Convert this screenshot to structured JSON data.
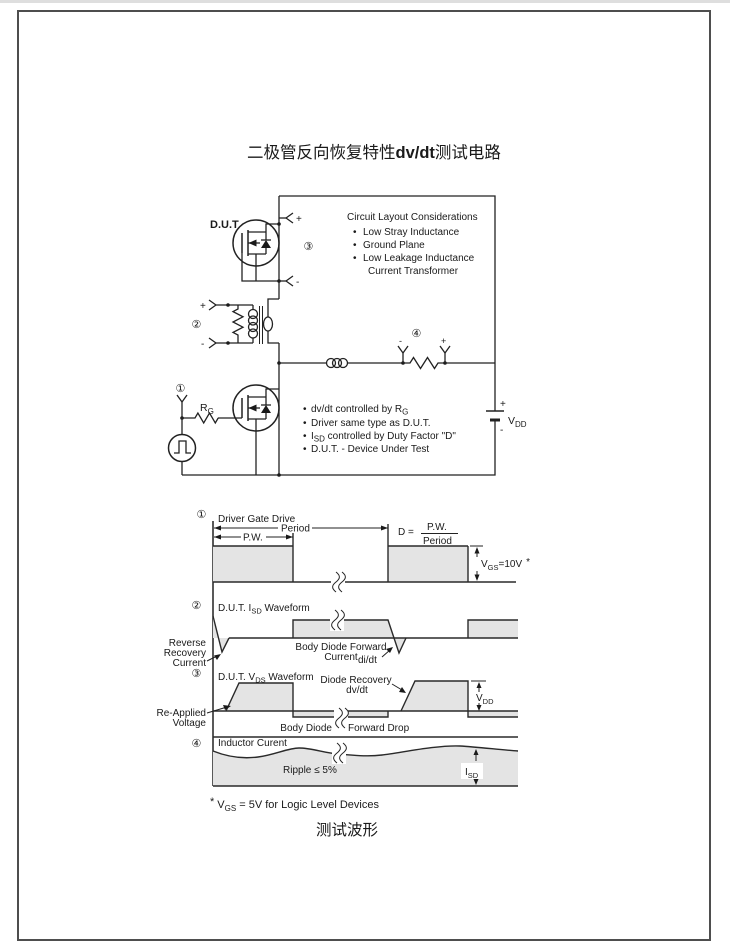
{
  "page": {
    "title": {
      "pre": "二极管反向恢复特性",
      "mid": "dv/dt",
      "post": "测试电路"
    },
    "bottom_title": "测试波形",
    "footnote": {
      "star": "*",
      "base": "V",
      "sub": "GS",
      "rest": " = 5V for Logic Level Devices"
    }
  },
  "symbols": {
    "plus": "+",
    "minus": "-",
    "bullet": "•"
  },
  "markers": {
    "m1": "①",
    "m2": "②",
    "m3": "③",
    "m4": "④"
  },
  "circuit": {
    "dut_label": "D.U.T",
    "rg": {
      "base": "R",
      "sub": "G"
    },
    "vdd": {
      "base": "V",
      "sub": "DD"
    },
    "layout_box": {
      "title": "Circuit Layout Considerations",
      "items": [
        "Low Stray Inductance",
        "Ground Plane",
        "Low Leakage Inductance"
      ],
      "continuation": "Current Transformer"
    },
    "notes": {
      "n1": {
        "pre": "dv/dt controlled by R",
        "sub": "G"
      },
      "n2": "Driver same type as D.U.T.",
      "n3": {
        "pre": "I",
        "sub": "SD",
        "post": " controlled by Duty Factor \"D\""
      },
      "n4": "D.U.T. - Device Under Test"
    }
  },
  "waveforms": {
    "w1": {
      "title": "Driver Gate Drive",
      "pw": "P.W.",
      "period": "Period",
      "duty_lhs": "D =",
      "duty_num": "P.W.",
      "duty_den": "Period",
      "vgs": {
        "base": "V",
        "sub": "GS",
        "value": "=10V",
        "star": "*"
      }
    },
    "w2": {
      "title_pre": "D.U.T. I",
      "title_sub": "SD",
      "title_post": " Waveform",
      "left1": "Reverse",
      "left2": "Recovery",
      "left3": "Current",
      "body1": "Body  Diode  Forward",
      "body2": "Current",
      "didt": "di/dt"
    },
    "w3": {
      "title_pre": "D.U.T. V",
      "title_sub": "DS",
      "title_post": " Waveform",
      "left1": "Re-Applied",
      "left2": "Voltage",
      "rec1": "Diode  Recovery",
      "rec2": "dv/dt",
      "body_left": "Body  Diode",
      "body_right": "Forward  Drop",
      "vdd": {
        "base": "V",
        "sub": "DD"
      }
    },
    "w4": {
      "title": "Inductor Curent",
      "ripple": "Ripple  ≤  5%",
      "isd": {
        "base": "I",
        "sub": "SD"
      }
    }
  }
}
